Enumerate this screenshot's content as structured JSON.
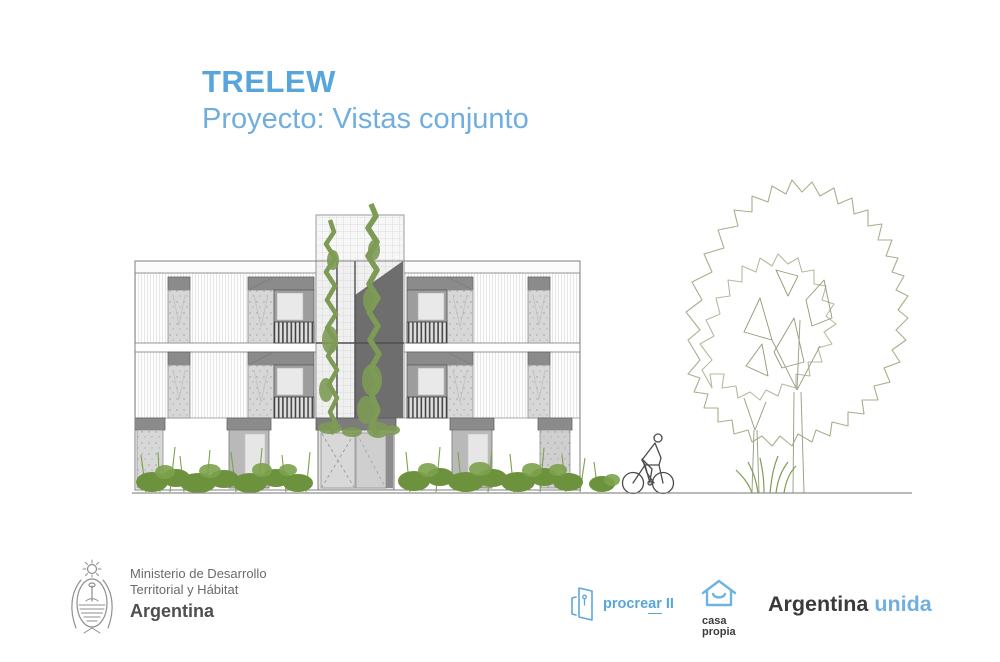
{
  "slide": {
    "title": "TRELEW",
    "subtitle": "Proyecto: Vistas conjunto"
  },
  "footer": {
    "ministry": {
      "icon": "argentina-coat-of-arms",
      "line1": "Ministerio de Desarrollo",
      "line2": "Territorial y Hábitat",
      "country": "Argentina"
    },
    "procrear": {
      "icon": "open-door-icon",
      "prefix": "procre",
      "underlined": "ar",
      "suffix": "II"
    },
    "casa_propia": {
      "icon": "smiling-house-icon",
      "line1": "casa",
      "line2": "propia"
    },
    "argentina_unida": {
      "dark": "Argentina",
      "blue": "unida"
    }
  },
  "colors": {
    "title_blue": "#58A5DB",
    "subtitle_blue": "#6FAEDF",
    "procrear_blue": "#58A7DA",
    "casa_propia_blue": "#6FB3E3",
    "unida_blue": "#70B0E0",
    "ministry_text_gray": "#6A6A6A",
    "drawing_gray": "#8A8A8A",
    "vine_green": "#7D9B55",
    "bush_green": "#6D923E",
    "tree_outline_green": "#A9AE8C"
  }
}
